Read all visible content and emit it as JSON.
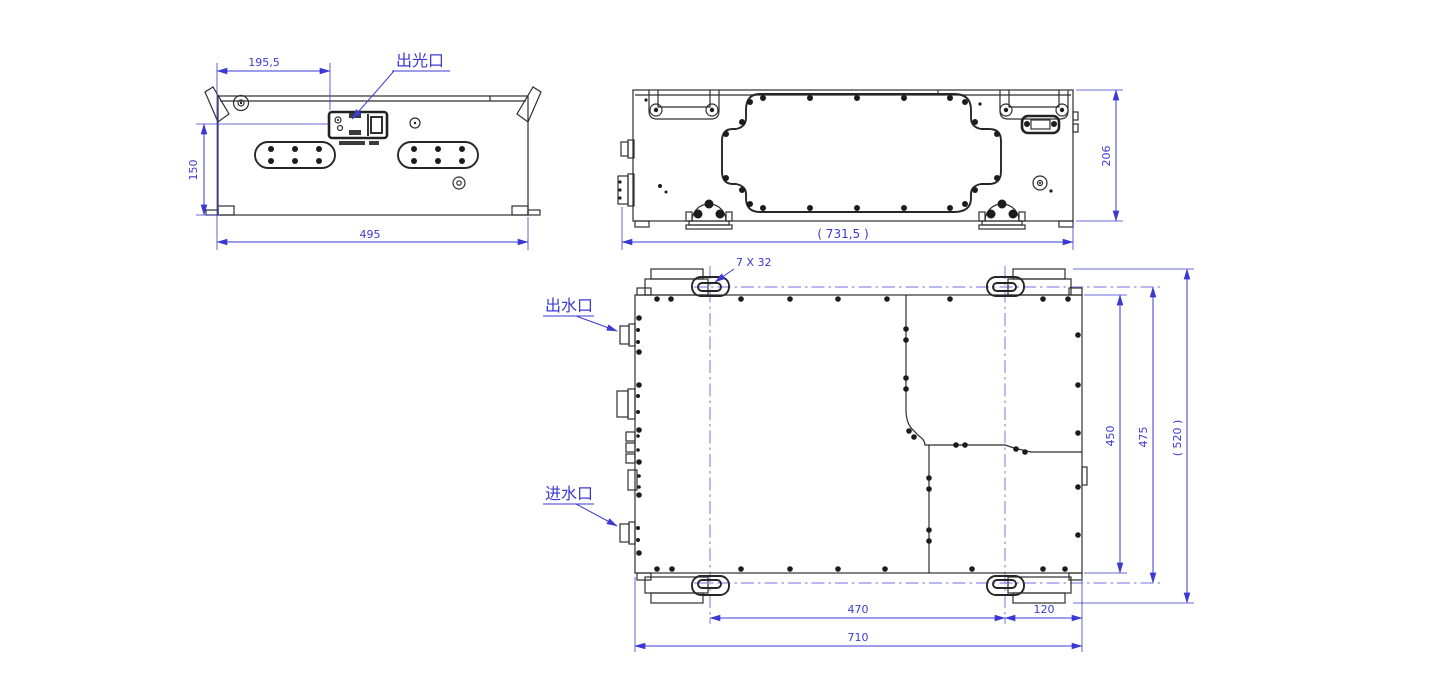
{
  "drawing": {
    "type": "engineering-cad-three-view",
    "labels": {
      "light_output": "出光口",
      "water_outlet": "出水口",
      "water_inlet": "进水口",
      "slot_callout": "7 X 32"
    },
    "dimensions": {
      "front": {
        "port_offset": "195,5",
        "height_to_port": "150",
        "width": "495"
      },
      "side": {
        "height": "206",
        "overall_width": "( 731,5 )"
      },
      "top": {
        "body_height": "450",
        "centerline_height": "475",
        "overall_height": "( 520 )",
        "slot_span": "470",
        "edge_offset": "120",
        "width": "710"
      }
    },
    "colors": {
      "dimension_blue": "#3a3ad2",
      "centerline_blue": "#8e8ee8",
      "line_dark": "#2e2e2e",
      "background": "#ffffff"
    }
  }
}
